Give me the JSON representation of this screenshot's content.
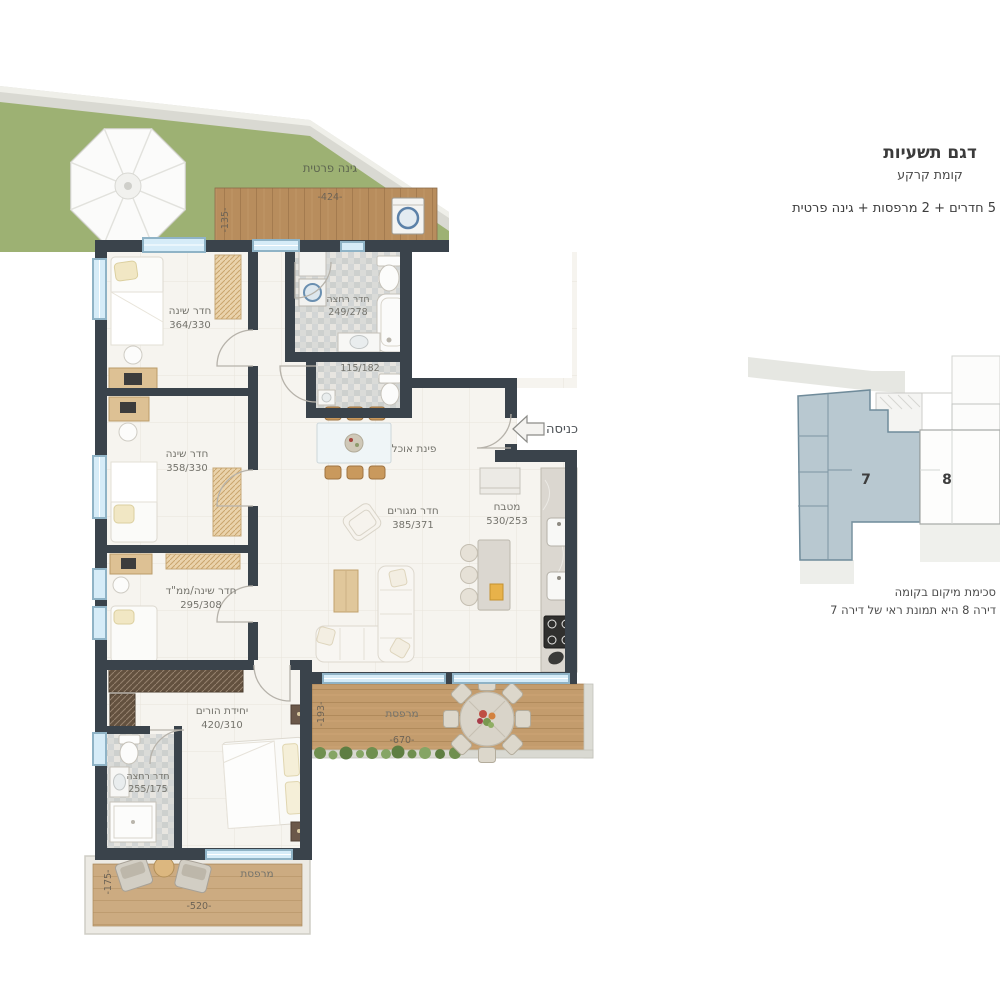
{
  "header": {
    "title": "דגם תשעיות",
    "subtitle": "קומת קרקע",
    "features": "5 חדרים + 2 מרפסות + גינה פרטית"
  },
  "plan": {
    "garden": {
      "label": "גינה פרטית",
      "deck_width": "-424-",
      "deck_depth": "-135-"
    },
    "entrance": {
      "label": "כניסה"
    },
    "rooms": {
      "bedroom1": {
        "name": "חדר שינה",
        "dims": "364/330"
      },
      "bathroom1": {
        "name": "חדר רחצה",
        "dims": "249/278"
      },
      "wc": {
        "dims": "115/182"
      },
      "dining": {
        "name": "פינת אוכל"
      },
      "bedroom2": {
        "name": "חדר שינה",
        "dims": "358/330"
      },
      "living": {
        "name": "חדר מגורים",
        "dims": "385/371"
      },
      "kitchen": {
        "name": "מטבח",
        "dims": "530/253"
      },
      "bedroom3": {
        "name": "חדר שינה/ממ\"ד",
        "dims": "295/308"
      },
      "master": {
        "name": "יחידת הורים",
        "dims": "420/310"
      },
      "bathroom2": {
        "name": "חדר רחצה",
        "dims": "255/175"
      }
    },
    "balcony_right": {
      "name": "מרפסת",
      "width": "-670-",
      "depth": "-193-"
    },
    "balcony_bottom": {
      "name": "מרפסת",
      "width": "-520-",
      "depth": "-175-"
    }
  },
  "locator": {
    "unit7": "7",
    "unit8": "8",
    "caption1": "סכימת מיקום בקומה",
    "caption2": "דירה 8 היא תמונת ראי של דירה 7"
  },
  "colors": {
    "wall": "#3a434b",
    "garden_green": "#9db173",
    "deck_wood": "#b88d5d",
    "balcony_wood": "#c39c6d",
    "window_glass": "#d6ecf8",
    "locator_highlight": "#b8c8d0"
  }
}
